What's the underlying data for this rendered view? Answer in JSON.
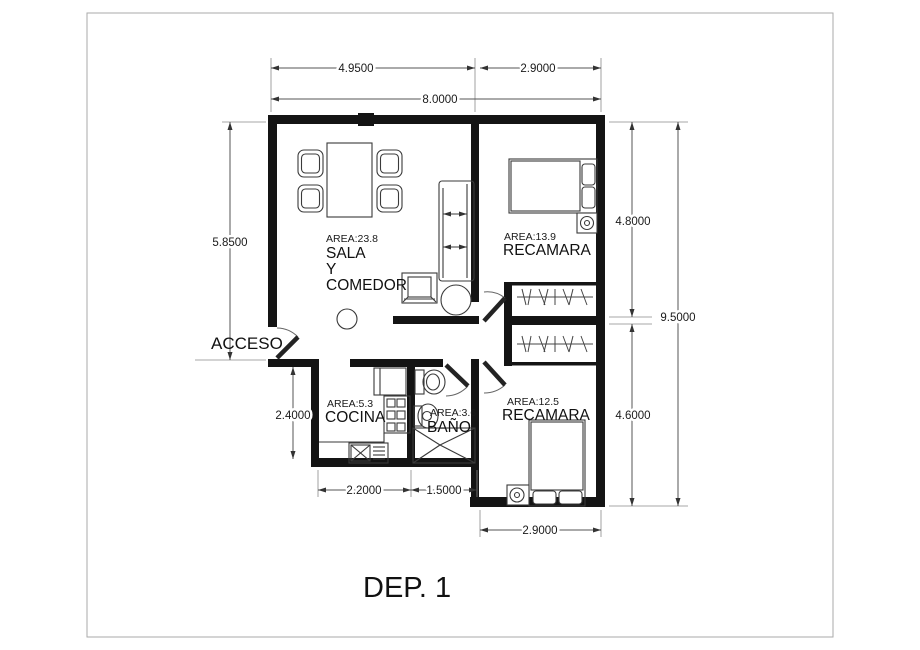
{
  "title": "DEP. 1",
  "labels": {
    "access": "ACCESO"
  },
  "rooms": {
    "sala": {
      "area": "AREA:23.8",
      "name_line1": "SALA",
      "name_line2": "Y",
      "name_line3": "COMEDOR"
    },
    "recamara_top": {
      "area": "AREA:13.9",
      "name": "RECAMARA"
    },
    "recamara_bottom": {
      "area": "AREA:12.5",
      "name": "RECAMARA"
    },
    "cocina": {
      "area": "AREA:5.3",
      "name": "COCINA"
    },
    "bano": {
      "area": "AREA:3.6",
      "name": "BAÑO"
    }
  },
  "dimensions": {
    "top_sala_width": "4.9500",
    "top_recamara_width": "2.9000",
    "top_total_width": "8.0000",
    "left_upper_height": "5.8500",
    "left_lower_height": "2.4000",
    "right_upper_height": "4.8000",
    "right_lower_height": "4.6000",
    "right_total_height": "9.5000",
    "bottom_cocina_width": "2.2000",
    "bottom_bano_width": "1.5000",
    "bottom_recamara_width": "2.9000"
  },
  "colors": {
    "wall": "#141414",
    "furniture": "#3a3a3a",
    "dim_line": "#555555",
    "text": "#1a1a1a",
    "background": "#ffffff"
  }
}
